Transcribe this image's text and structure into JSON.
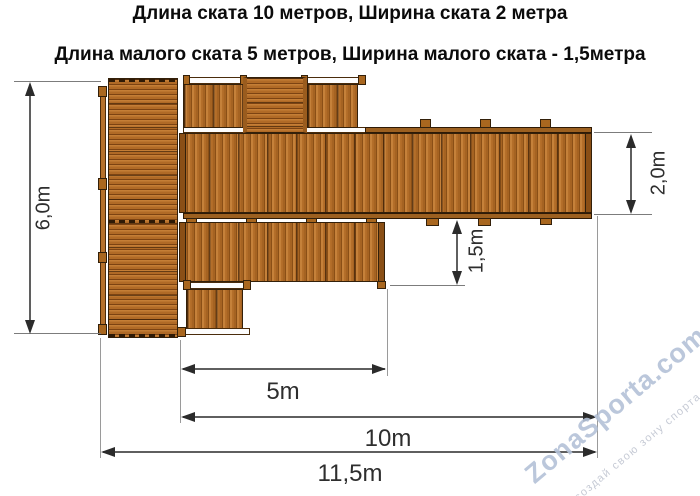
{
  "title": {
    "line1": "Длина ската 10 метров, Ширина ската 2 метра",
    "line2": "Длина малого ската 5 метров, Ширина малого ската - 1,5метра"
  },
  "dimensions": {
    "total_height": "6,0m",
    "main_ramp_width": "2,0m",
    "small_ramp_width": "1,5m",
    "small_ramp_length": "5m",
    "main_ramp_length": "10m",
    "total_length": "11,5m"
  },
  "watermark": {
    "brand": "ZonaSporta.com",
    "slogan": "создай свою зону спорта"
  },
  "colors": {
    "wood_light": "#c5813a",
    "wood_mid": "#b06a26",
    "wood_seam": "#8a4f16",
    "wood_outline": "#33200a",
    "dimension_line": "#5f5f5f",
    "dimension_text": "#2e2e2e",
    "watermark_blue": "#b4c2d8"
  }
}
